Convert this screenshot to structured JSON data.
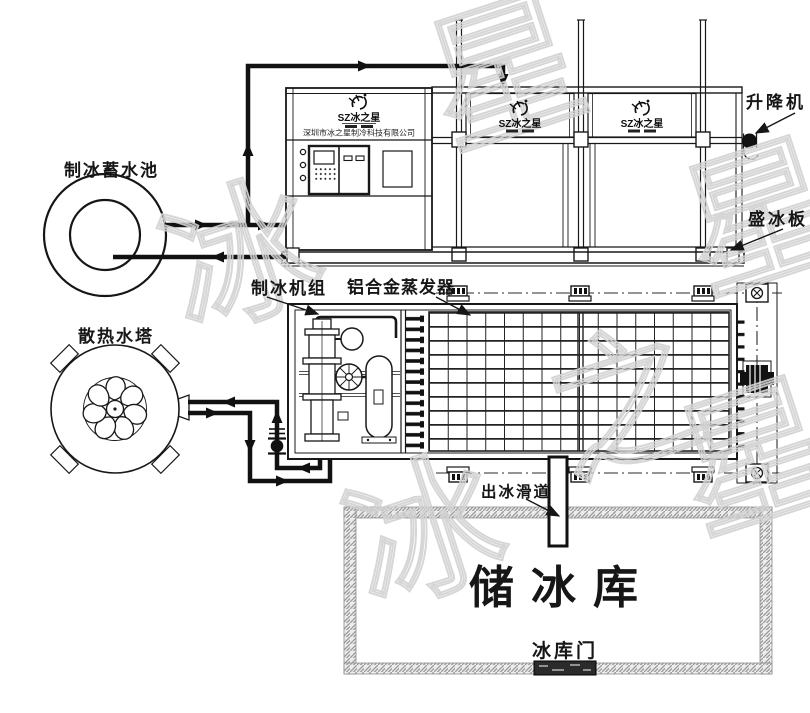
{
  "diagram": {
    "labels": {
      "water_pool": "制冰蓄水池",
      "cooling_tower": "散热水塔",
      "ice_machine_unit": "制冰机组",
      "evaporator": "铝合金蒸发器",
      "elevator": "升降机",
      "ice_plate": "盛冰板",
      "ice_slide": "出冰滑道",
      "ice_storage": "储冰库",
      "storage_door": "冰库门"
    },
    "logo": {
      "brand": "SZ冰之星",
      "company": "深圳市冰之星制冷科技有限公司"
    },
    "watermark": {
      "glyphs": [
        "冰",
        "之",
        "星"
      ]
    },
    "colors": {
      "line": "#181818",
      "pipe": "#111111",
      "wall": "#9a9a9a",
      "watermark": "#d2d2d2",
      "background": "#ffffff"
    }
  }
}
